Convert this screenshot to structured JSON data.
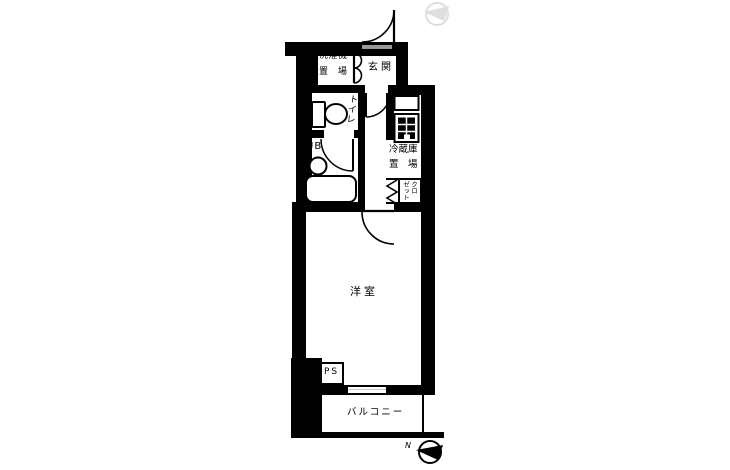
{
  "plan_title": "apartment-floor-plan",
  "colors": {
    "wall": "#000000",
    "background": "#ffffff",
    "threshold": "#9a9a9a",
    "window": "#c8c8c8",
    "ghost_compass": "#dedede"
  },
  "rooms": {
    "washer": {
      "line1": "洗濯機",
      "line2": "置　場"
    },
    "entrance": {
      "label": "玄関"
    },
    "toilet": {
      "label": "トイレ"
    },
    "bath": {
      "label": "UB"
    },
    "fridge": {
      "line1": "冷蔵庫",
      "line2": "置　場"
    },
    "closet": {
      "col1": "クロ",
      "col2": "ゼット"
    },
    "main_room": {
      "label": "洋室"
    },
    "pipe_space": {
      "label": "PS"
    },
    "balcony": {
      "label": "バルコニー"
    }
  },
  "compass": {
    "north_label": "N"
  }
}
